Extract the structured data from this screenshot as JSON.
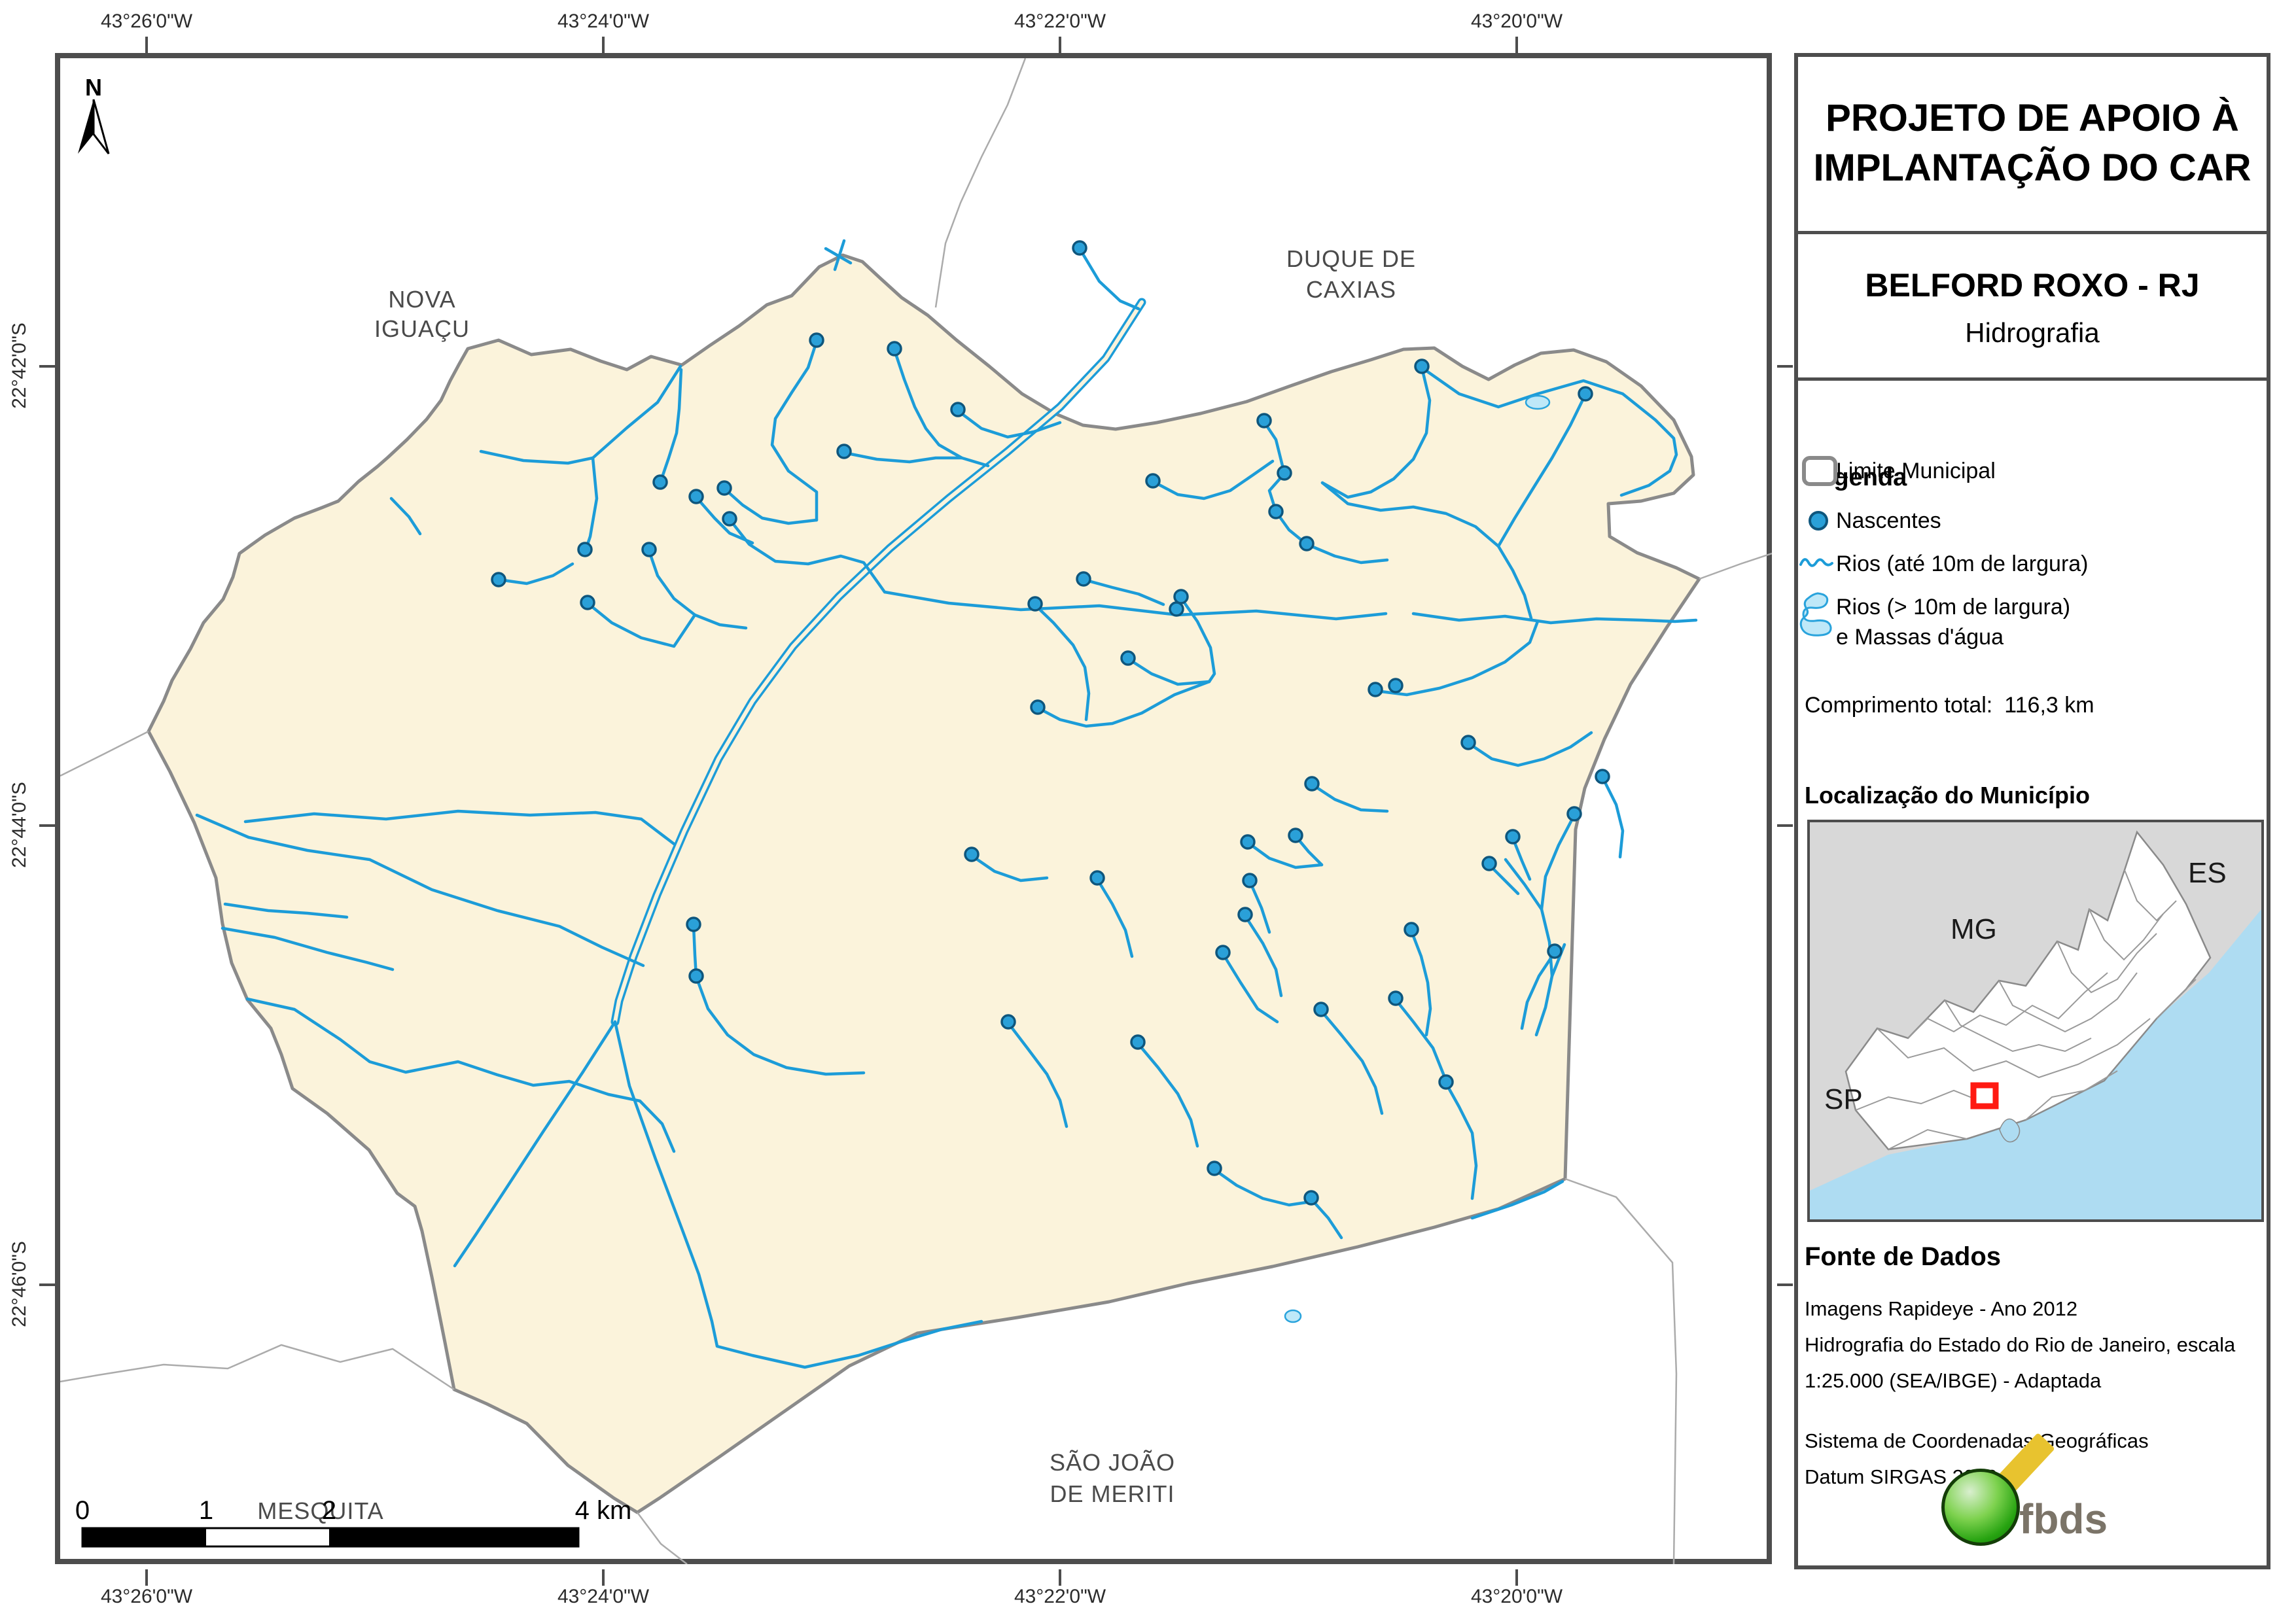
{
  "map": {
    "labels": {
      "north": "N",
      "nova_iguacu": [
        "NOVA",
        "IGUAÇU"
      ],
      "duque_de_caxias": [
        "DUQUE DE",
        "CAXIAS"
      ],
      "sao_joao_de_meriti": [
        "SÃO JOÃO",
        "DE MERITI"
      ],
      "mesquita": "MESQUITA"
    },
    "coords_top": [
      "43°26'0\"W",
      "43°24'0\"W",
      "43°22'0\"W",
      "43°20'0\"W"
    ],
    "coords_bottom": [
      "43°26'0\"W",
      "43°24'0\"W",
      "43°22'0\"W",
      "43°20'0\"W"
    ],
    "coords_left": [
      "22°42'0\"S",
      "22°44'0\"S",
      "22°46'0\"S"
    ],
    "scalebar": {
      "labels": [
        "0",
        "1",
        "2"
      ],
      "end_label": "4 km"
    },
    "nascentes": [
      [
        1248,
        520
      ],
      [
        1367,
        533
      ],
      [
        1290,
        690
      ],
      [
        1009,
        737
      ],
      [
        1064,
        759
      ],
      [
        1107,
        746
      ],
      [
        1115,
        793
      ],
      [
        894,
        840
      ],
      [
        992,
        840
      ],
      [
        762,
        886
      ],
      [
        898,
        921
      ],
      [
        1650,
        379
      ],
      [
        1464,
        626
      ],
      [
        2173,
        560
      ],
      [
        2423,
        602
      ],
      [
        1762,
        735
      ],
      [
        1963,
        723
      ],
      [
        1950,
        782
      ],
      [
        1997,
        831
      ],
      [
        1932,
        643
      ],
      [
        1656,
        885
      ],
      [
        1582,
        923
      ],
      [
        1805,
        912
      ],
      [
        1798,
        931
      ],
      [
        1724,
        1006
      ],
      [
        1586,
        1081
      ],
      [
        2102,
        1054
      ],
      [
        2133,
        1048
      ],
      [
        2244,
        1135
      ],
      [
        2005,
        1198
      ],
      [
        2449,
        1187
      ],
      [
        2406,
        1244
      ],
      [
        1485,
        1306
      ],
      [
        1980,
        1277
      ],
      [
        2312,
        1279
      ],
      [
        1910,
        1346
      ],
      [
        2276,
        1320
      ],
      [
        1903,
        1398
      ],
      [
        1869,
        1456
      ],
      [
        2157,
        1421
      ],
      [
        2376,
        1454
      ],
      [
        2019,
        1543
      ],
      [
        2133,
        1526
      ],
      [
        1541,
        1562
      ],
      [
        1739,
        1593
      ],
      [
        2210,
        1654
      ],
      [
        1856,
        1786
      ],
      [
        2004,
        1831
      ],
      [
        1060,
        1413
      ],
      [
        1064,
        1492
      ],
      [
        1677,
        1342
      ],
      [
        1907,
        1287
      ]
    ]
  },
  "panel": {
    "title_line1": "PROJETO DE APOIO À",
    "title_line2": "IMPLANTAÇÃO DO CAR",
    "municipality": "BELFORD ROXO - RJ",
    "map_theme": "Hidrografia",
    "legend": {
      "heading": "Legenda",
      "item_limite": "Limite Municipal",
      "item_nascentes": "Nascentes",
      "item_rios": "Rios (até 10m de largura)",
      "item_rios_largos_1": "Rios (> 10m de largura)",
      "item_rios_largos_2": "e Massas d'água",
      "total_label": "Comprimento total:",
      "total_value": "116,3 km"
    },
    "location": {
      "heading": "Localização do Município",
      "state_mg": "MG",
      "state_es": "ES",
      "state_sp": "SP"
    },
    "source": {
      "heading": "Fonte de Dados",
      "line1": "Imagens Rapideye - Ano 2012",
      "line2": "Hidrografia do Estado do Rio de Janeiro, escala",
      "line3": "1:25.000 (SEA/IBGE) - Adaptada",
      "line4": "Sistema de Coordenadas Geográficas",
      "line5": "Datum SIRGAS 2000"
    },
    "logo_text": "fbds"
  },
  "colors": {
    "municipality_fill": "#FBF3DB",
    "municipality_border": "#8A8A8A",
    "river_blue": "#1C9CD8",
    "nascente_fill": "#2AA0D8",
    "nascente_stroke": "#0E567D",
    "water_fill": "#BEE8F8",
    "frame_gray": "#4D4D4D",
    "inset_land_gray": "#D8D8D8",
    "inset_ocean": "#AEDCF2",
    "marker_red": "#FF1A12",
    "logo_green": "#27A311",
    "logo_yellow": "#E8C32F",
    "logo_gray": "#7B7468"
  }
}
